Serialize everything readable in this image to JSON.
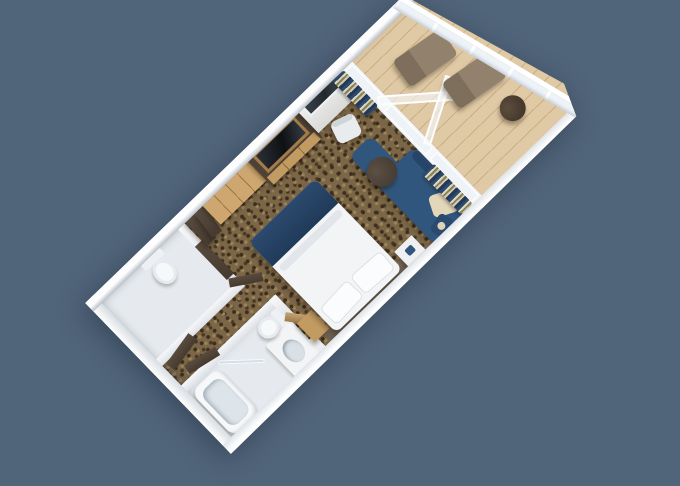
{
  "meta": {
    "title": "3D rendered cruise-ship stateroom floor plan, rotated isometric top view on slate-blue background",
    "view_rotation_deg": -44
  },
  "colors": {
    "bg": "#50647a",
    "carpet1": "#7b6647",
    "carpet2": "#3d2e1c",
    "carpet3": "#9c8459",
    "plank": "#e0c9a5",
    "plankseam": "#c9ad83",
    "glass": "#eef3f8",
    "tile": "#e6eaee",
    "fixture": "#f6f8fa",
    "wood1": "#cda76f",
    "wood2": "#c29b63",
    "doorbrown": "#594b3e",
    "tvframe": "#a57c49",
    "tvscreen": "#0e1114",
    "duvet": "#f3f4f6",
    "runner": "#2c4a6e",
    "headboard": "#665a4c",
    "sofa": "#31567d",
    "cream": "#e3d7ba",
    "lounger": "#92816c",
    "tabledark": "#3f362d",
    "curtnavy": "#2e4a6b",
    "curtcream": "#d9d6c6",
    "curtgold": "#8a814f"
  },
  "scene": {
    "rooms": [
      {
        "name": "main-cabin",
        "floor": "patterned brown carpet"
      },
      {
        "name": "balcony",
        "floor": "light wood planks",
        "enclosure": "white rail with glass panels"
      },
      {
        "name": "bathroom",
        "floor": "white tile",
        "fixtures": [
          "bathtub",
          "sink-vanity",
          "toilet",
          "shower-glass"
        ]
      },
      {
        "name": "water-closet",
        "floor": "white tile",
        "fixtures": [
          "toilet"
        ]
      },
      {
        "name": "entry",
        "doors": "dark brown leaves standing open"
      }
    ],
    "furniture": [
      {
        "name": "bed",
        "desc": "white duvet, navy runner at foot, two white pillows, dark headboard on wall"
      },
      {
        "name": "sofa",
        "desc": "navy L-shaped sofa with cream and navy pillows"
      },
      {
        "name": "coffee-table",
        "desc": "round dark wood table"
      },
      {
        "name": "tv-console",
        "desc": "wood-framed TV over wood drawer cabinet"
      },
      {
        "name": "wardrobe",
        "desc": "light wood closet doors"
      },
      {
        "name": "desk-vanity",
        "desc": "desk with dark mirror and white chair"
      },
      {
        "name": "curtains",
        "desc": "navy/cream/gold striped curtain bunches beside balcony door"
      },
      {
        "name": "loungers",
        "desc": "two taupe balcony lounge chairs"
      },
      {
        "name": "balcony-table",
        "desc": "small round dark table"
      },
      {
        "name": "nightstands",
        "desc": "wood nightstand and white side table"
      }
    ]
  }
}
